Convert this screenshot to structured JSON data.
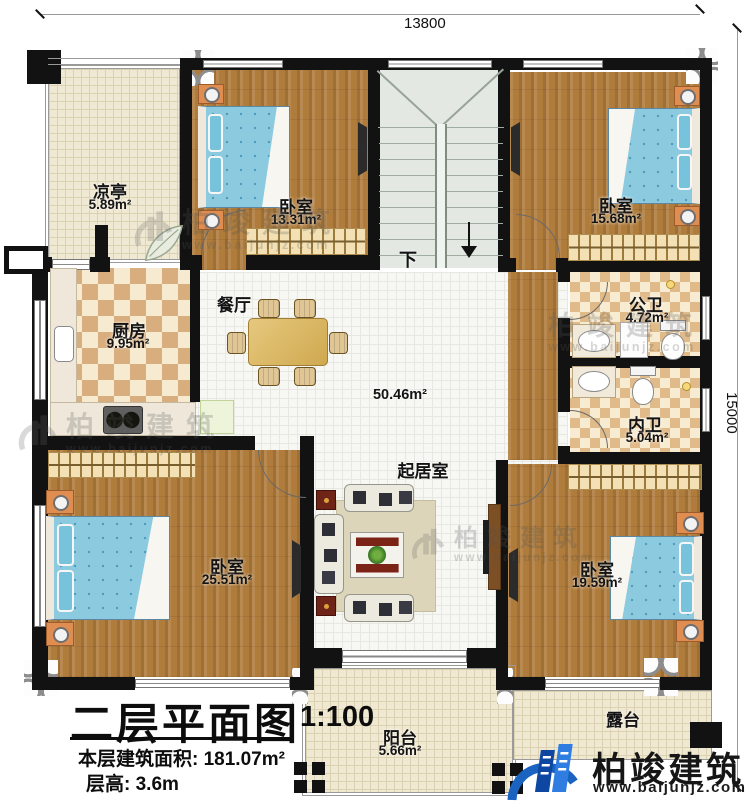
{
  "dimensions": {
    "top": "13800",
    "right": "15000"
  },
  "stairs": {
    "down": "下"
  },
  "rooms": {
    "pavilion": {
      "name": "凉亭",
      "area": "5.89m²"
    },
    "bedroom_nw": {
      "name": "卧室",
      "area": "13.31m²"
    },
    "bedroom_ne": {
      "name": "卧室",
      "area": "15.68m²"
    },
    "kitchen": {
      "name": "厨房",
      "area": "9.95m²"
    },
    "dining": {
      "name": "餐厅"
    },
    "living": {
      "name": "起居室",
      "area": "50.46m²"
    },
    "bath_public": {
      "name": "公卫",
      "area": "4.72m²"
    },
    "bath_private": {
      "name": "内卫",
      "area": "5.04m²"
    },
    "bedroom_sw": {
      "name": "卧室",
      "area": "25.51m²"
    },
    "bedroom_se": {
      "name": "卧室",
      "area": "19.59m²"
    },
    "balcony": {
      "name": "阳台",
      "area": "5.66m²"
    },
    "terrace": {
      "name": "露台"
    }
  },
  "title_block": {
    "title": "二层平面图",
    "scale": "1:100",
    "floor_area_label": "本层建筑面积:",
    "floor_area_value": "181.07m²",
    "floor_height_label": "层高:",
    "floor_height_value": "3.6m"
  },
  "brand": {
    "name": "柏竣建筑",
    "url": "www.baijunjz.com"
  },
  "watermark": {
    "name": "柏竣建筑",
    "url": "www.baijunjz.com"
  }
}
